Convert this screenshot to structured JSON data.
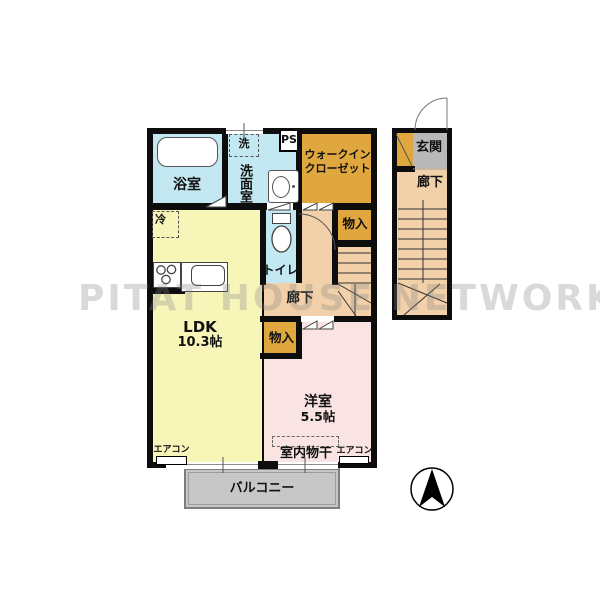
{
  "watermark": "PITAT HOUSE NETWORK",
  "plan": {
    "bathroom": "浴室",
    "washer_storage": "洗",
    "washroom": "洗面室",
    "pipe_space": "PS",
    "walkin_closet_line1": "ウォークイン",
    "walkin_closet_line2": "クローゼット",
    "refrigerator": "冷",
    "toilet": "トイレ",
    "hallway_main": "廊下",
    "closet_upper": "物入",
    "closet_lower": "物入",
    "ldk_name": "LDK",
    "ldk_size": "10.3帖",
    "western_room_name": "洋室",
    "western_room_size": "5.5帖",
    "indoor_drying": "室内物干",
    "aircon_left": "エアコン",
    "aircon_right": "エアコン",
    "balcony": "バルコニー",
    "entrance": "玄関",
    "hallway_entry": "廊下"
  },
  "colors": {
    "water_blue": "#c4e8f2",
    "storage_orange": "#dfa73e",
    "ldk_yellow": "#f8f5b9",
    "hall_peach": "#f2d1aa",
    "room_pink": "#fae4e3",
    "entrance_gray": "#b9b9b9",
    "balcony_gray": "#c7c7c7",
    "wall_black": "#0d0d0d",
    "watermark_gray": "#8080804d"
  }
}
